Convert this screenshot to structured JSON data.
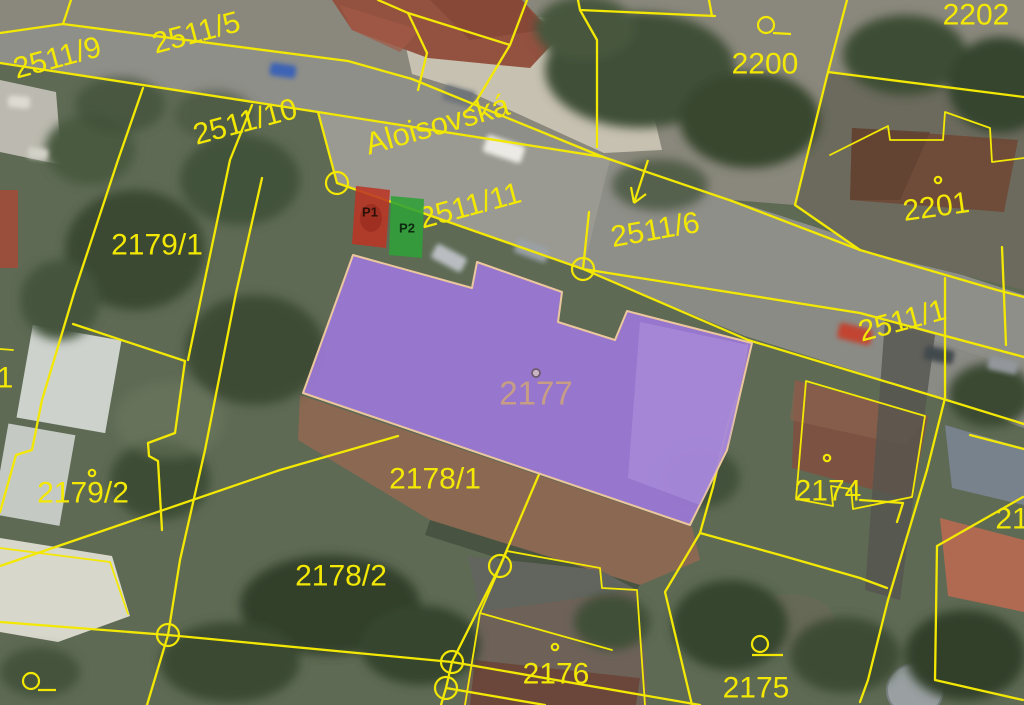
{
  "map": {
    "kind": "cadastral-parcel-map-over-aerial-photo",
    "street": {
      "label": "Aloisovská"
    },
    "highlighted_parcel": {
      "label": "2177"
    },
    "markers": [
      {
        "label": "P1"
      },
      {
        "label": "P2"
      }
    ],
    "parcel_labels": [
      "2511/9",
      "2511/5",
      "2511/10",
      "2511/11",
      "2511/6",
      "2200",
      "2202",
      "2201",
      "2511/1",
      "2179/1",
      "2179/2",
      "2178/1",
      "2178/2",
      "2176",
      "2175",
      "2174"
    ],
    "partial_labels": [
      "21",
      "1"
    ],
    "colors": {
      "boundary": "#f3e804",
      "highlight_fill": "#9b79d6",
      "highlight_border": "#ecc79e",
      "highlight_label": "#c79e85",
      "marker_p1": "#bb3425",
      "marker_p2": "#2fa038"
    }
  }
}
